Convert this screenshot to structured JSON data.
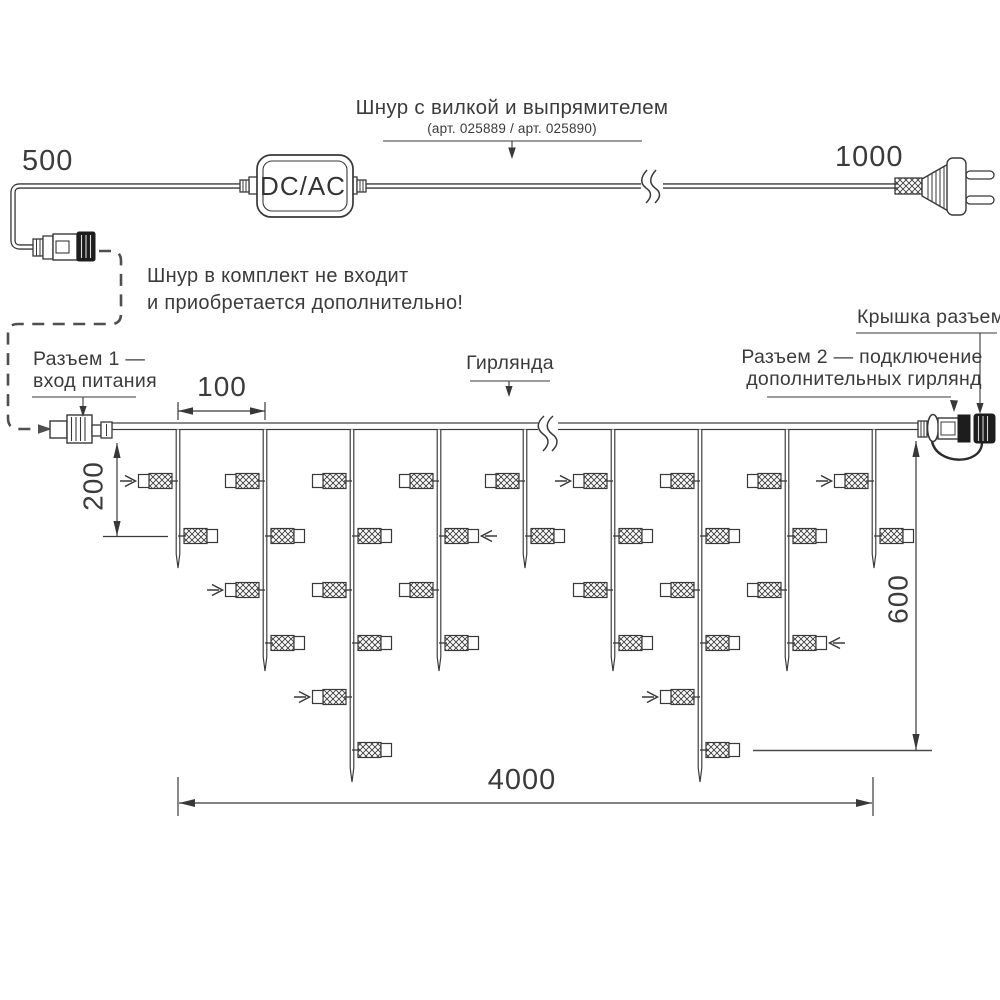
{
  "colors": {
    "line": "#383838",
    "dash": "#4f4f4f",
    "dark_fill": "#1d1d1d",
    "text": "#3b3b3b"
  },
  "top_cord": {
    "dim_left": "500",
    "dim_right": "1000",
    "converter_label": "DC/AC",
    "title": "Шнур с вилкой и выпрямителем",
    "sku": "(арт. 025889 / арт. 025890)",
    "note_line1": "Шнур в комплект не входит",
    "note_line2": "и приобретается дополнительно!"
  },
  "garland": {
    "label": "Гирлянда",
    "connector1_line1": "Разъем 1 —",
    "connector1_line2": "вход питания",
    "connector2_line1": "Разъем 2 — подключение",
    "connector2_line2": "дополнительных гирлянд",
    "cap_label": "Крышка разъема",
    "dim_spacing": "100",
    "dim_first_drop": "200",
    "dim_max_drop": "600",
    "dim_total_length": "4000"
  },
  "diagram": {
    "wire_y_top": 423,
    "wire_height": 6.5,
    "wire_x1": 112,
    "wire_x2": 918,
    "bulb_row_ys": [
      481,
      536,
      590,
      643,
      697,
      750
    ],
    "drops": [
      {
        "x": 178,
        "tip": 568,
        "bulbs": 2,
        "arrows": [
          1
        ]
      },
      {
        "x": 265,
        "tip": 671,
        "bulbs": 4,
        "arrows": [
          3
        ]
      },
      {
        "x": 352,
        "tip": 782,
        "bulbs": 6,
        "arrows": [
          5
        ]
      },
      {
        "x": 439,
        "tip": 671,
        "bulbs": 4,
        "arrows": [
          2
        ]
      },
      {
        "x": 525,
        "tip": 568,
        "bulbs": 2,
        "arrows": []
      },
      {
        "x": 613,
        "tip": 671,
        "bulbs": 4,
        "arrows": [
          1
        ]
      },
      {
        "x": 700,
        "tip": 782,
        "bulbs": 6,
        "arrows": [
          5
        ]
      },
      {
        "x": 787,
        "tip": 671,
        "bulbs": 4,
        "arrows": [
          4
        ]
      },
      {
        "x": 874,
        "tip": 568,
        "bulbs": 2,
        "arrows": [
          1
        ]
      }
    ]
  }
}
